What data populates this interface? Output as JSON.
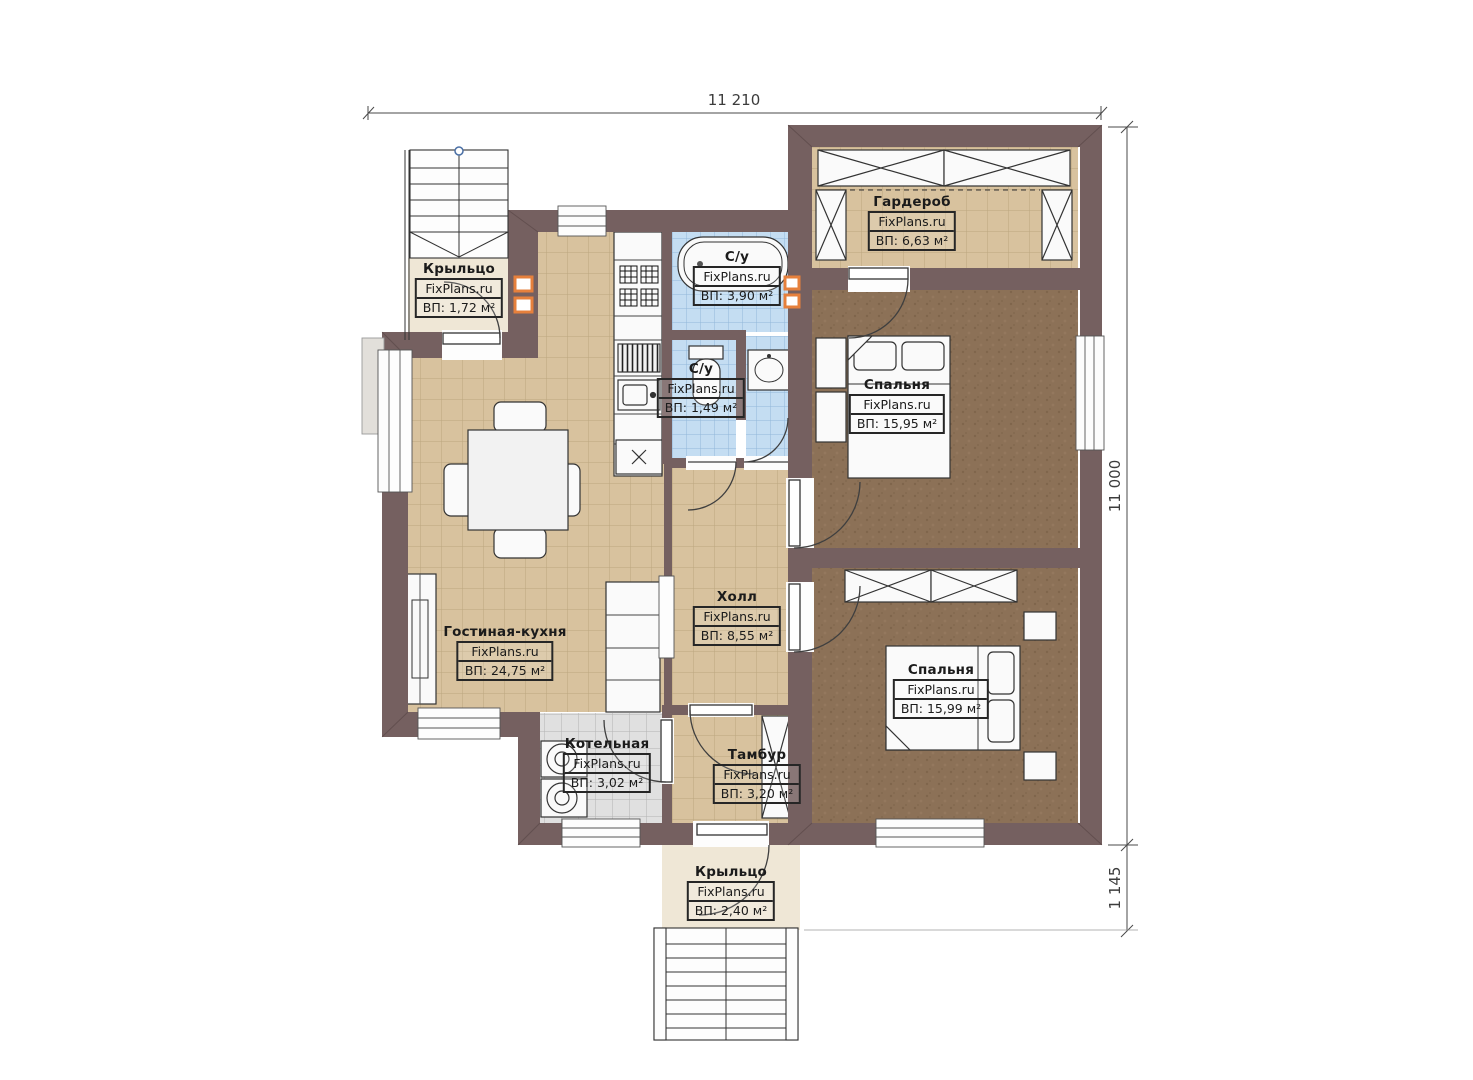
{
  "brand": "FixPlans.ru",
  "dimensions": {
    "top": "11 210",
    "right": "11 000",
    "right_bottom": "1 145"
  },
  "rooms": [
    {
      "id": "porch-top",
      "name": "Крыльцо",
      "area": "ВП: 1,72 м²"
    },
    {
      "id": "wardrobe",
      "name": "Гардероб",
      "area": "ВП: 6,63 м²"
    },
    {
      "id": "bathroom",
      "name": "С/у",
      "area": "ВП: 3,90 м²"
    },
    {
      "id": "wc",
      "name": "С/у",
      "area": "ВП: 1,49 м²"
    },
    {
      "id": "bedroom-1",
      "name": "Спальня",
      "area": "ВП: 15,95 м²"
    },
    {
      "id": "living-kitchen",
      "name": "Гостиная-кухня",
      "area": "ВП: 24,75 м²"
    },
    {
      "id": "hall",
      "name": "Холл",
      "area": "ВП: 8,55 м²"
    },
    {
      "id": "bedroom-2",
      "name": "Спальня",
      "area": "ВП: 15,99 м²"
    },
    {
      "id": "boiler",
      "name": "Котельная",
      "area": "ВП: 3,02 м²"
    },
    {
      "id": "vestibule",
      "name": "Тамбур",
      "area": "ВП: 3,20 м²"
    },
    {
      "id": "porch-bottom",
      "name": "Крыльцо",
      "area": "ВП: 2,40 м²"
    }
  ],
  "colors": {
    "wall": "#756060",
    "floor_tile_tan": "#D8C29E",
    "floor_bedroom_brown": "#8C7157",
    "floor_tile_blue": "#C4DDF2",
    "floor_tile_grey": "#E0E0E0",
    "porch_floor": "#EFE7D6",
    "vent_marker_orange": "#E6803C"
  }
}
